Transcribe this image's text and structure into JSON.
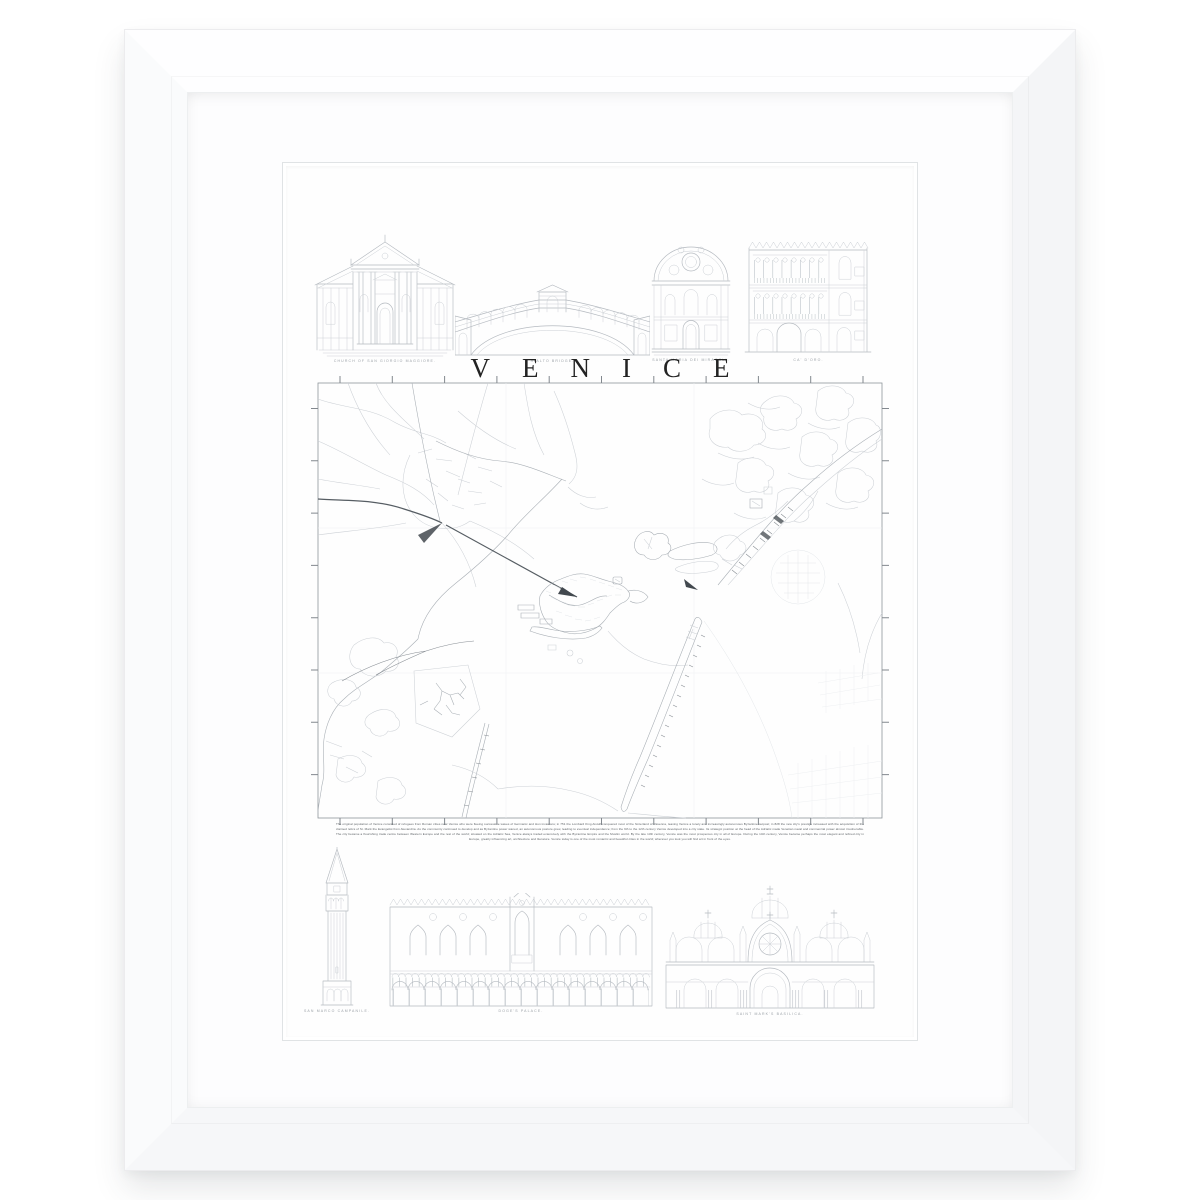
{
  "colors": {
    "frame": "#ffffff",
    "mat": "#fdfdfe",
    "paper": "#fefefe",
    "title_ink": "#232323",
    "line_light": "#cdd1d6",
    "line_mid": "#aab0b6",
    "line_dark": "#565d63",
    "caption": "#9aa0a6"
  },
  "print": {
    "title": "VENICE",
    "top_row": [
      {
        "label": "CHURCH OF SAN GIORGIO MAGGIORE."
      },
      {
        "label": "RIALTO BRIDGE."
      },
      {
        "label": "SANTA MARIA DEI MIRACOLI."
      },
      {
        "label": "CA' D'ORO."
      }
    ],
    "bottom_row": [
      {
        "label": "SAN MARCO CAMPANILE."
      },
      {
        "label": "DOGE'S PALACE."
      },
      {
        "label": "SAINT MARK'S BASILICA."
      }
    ],
    "description": "The original population of Venice consisted of refugees from Roman cities near Venice who were fleeing successive waves of Germanic and Hun invasions; in 751 the Lombard King Aistulf conquered most of the hinterland of Ravenna, leaving Venice a lonely and increasingly autonomous Byzantine outpost; in 828 the new city's prestige increased with the acquisition of the claimed relics of St. Mark the Evangelist from Alexandria. As the community continued to develop and as Byzantine power waned, an autonomous posture grew, leading to eventual independence; from the 9th to the 12th century Venice developed into a city state. Its strategic position at the head of the Adriatic made Venetian naval and commercial power almost invulnerable. The city became a flourishing trade centre between Western Europe and the rest of the world; situated on the Adriatic Sea, Venice always traded extensively with the Byzantine Empire and the Muslim world. By the late 13th century, Venice was the most prosperous city in all of Europe. During the 14th century, Venice became perhaps the most elegant and refined city in Europe, greatly influencing art, architecture and literature. Venice today is one of the most romantic and beautiful cities in the world; wherever you look you will find art in front of the eyes."
  }
}
